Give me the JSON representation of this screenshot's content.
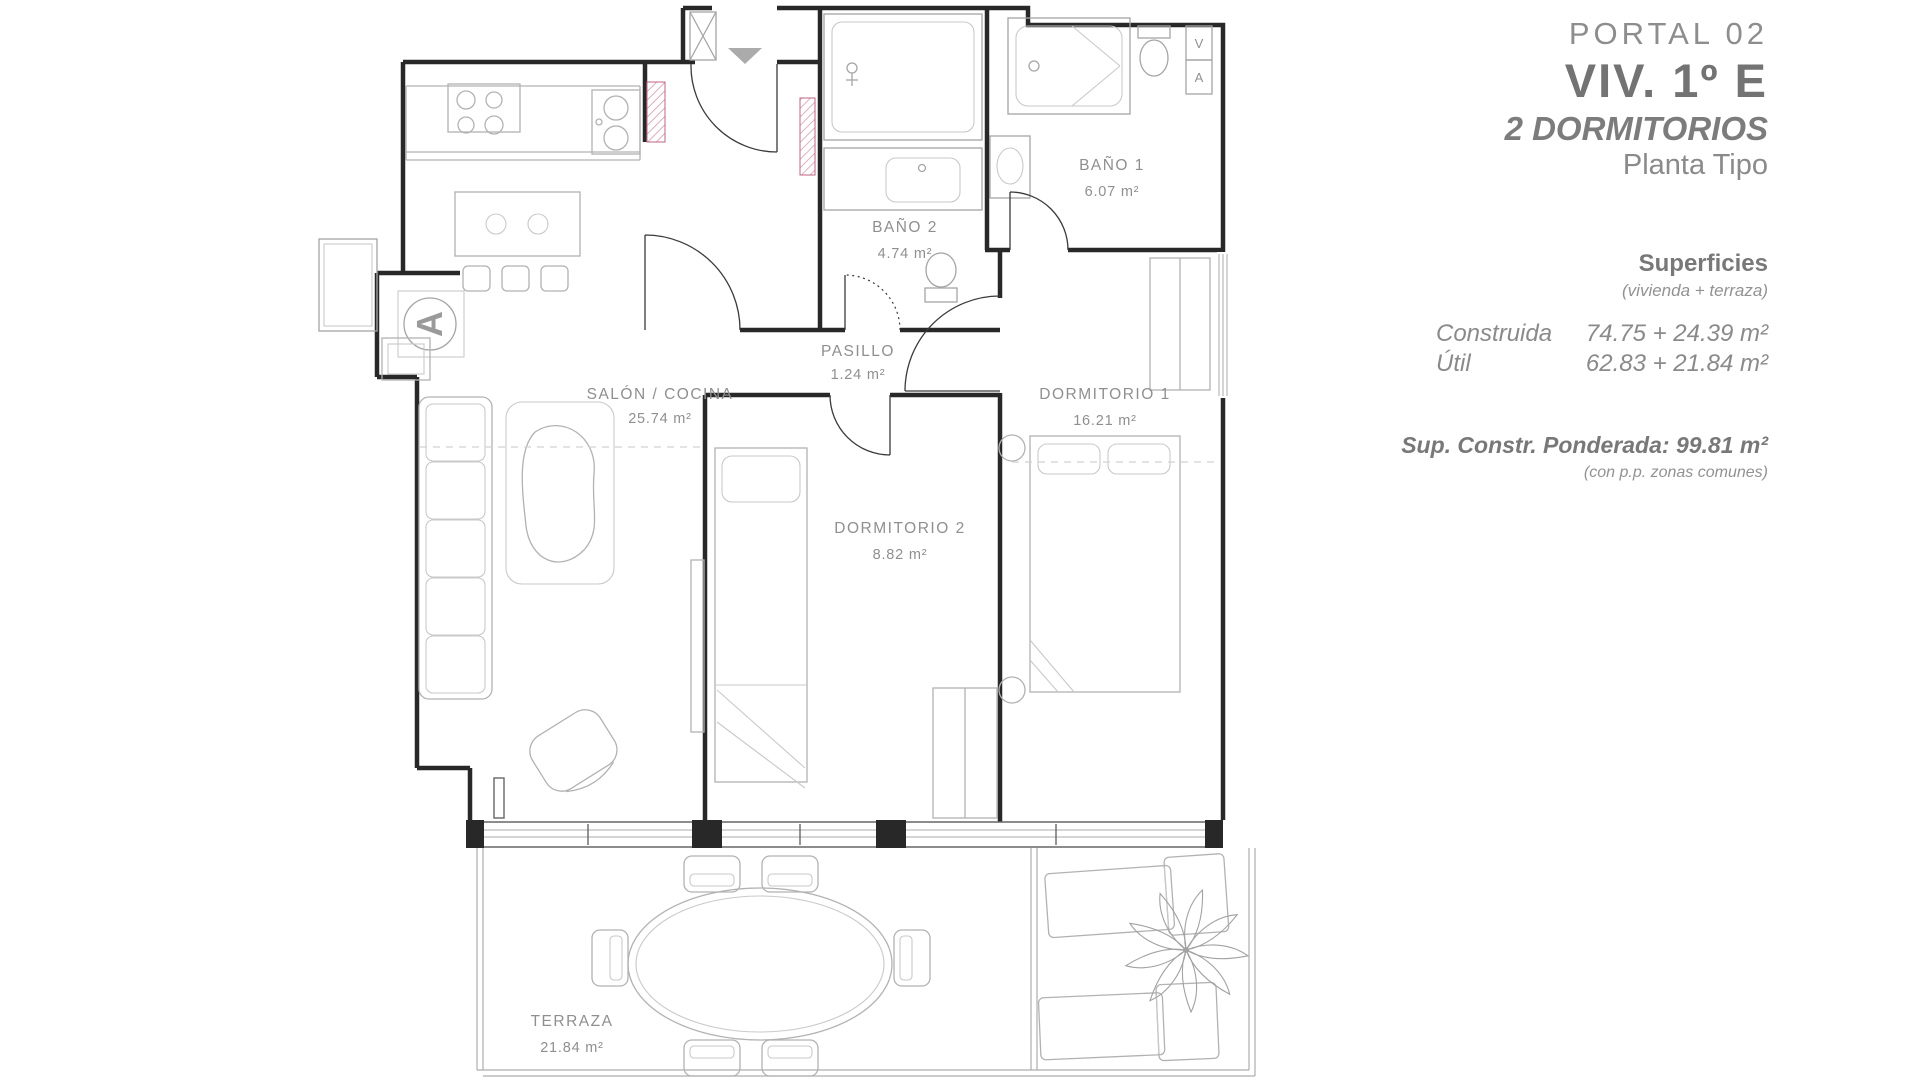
{
  "title_block": {
    "portal": "PORTAL 02",
    "unit": "VIV. 1º E",
    "bedrooms": "2 DORMITORIOS",
    "floor_type": "Planta Tipo",
    "surfaces": {
      "heading": "Superficies",
      "subheading": "(vivienda + terraza)",
      "rows": [
        {
          "label": "Construida",
          "value": "74.75 + 24.39 m²"
        },
        {
          "label": "Útil",
          "value": "62.83 + 21.84 m²"
        }
      ],
      "weighted": "Sup. Constr. Ponderada: 99.81 m²",
      "weighted_note": "(con p.p. zonas comunes)"
    }
  },
  "floor_plan": {
    "rooms": [
      {
        "id": "bano1",
        "name": "BAÑO 1",
        "area": "6.07 m²"
      },
      {
        "id": "bano2",
        "name": "BAÑO 2",
        "area": "4.74 m²"
      },
      {
        "id": "pasillo",
        "name": "PASILLO",
        "area": "1.24 m²"
      },
      {
        "id": "salon",
        "name": "SALÓN / COCINA",
        "area": "25.74 m²"
      },
      {
        "id": "dorm1",
        "name": "DORMITORIO 1",
        "area": "16.21 m²"
      },
      {
        "id": "dorm2",
        "name": "DORMITORIO 2",
        "area": "8.82 m²"
      },
      {
        "id": "terraza",
        "name": "TERRAZA",
        "area": "21.84 m²"
      }
    ],
    "markers": {
      "section_marker": "A",
      "vent_v": "V",
      "vent_a": "A"
    },
    "colors": {
      "wall": "#282828",
      "furniture": "#b2b2b2",
      "shaft_hatch": "#c4728f",
      "label": "#8f8f8f",
      "entrance_arrow": "#ababab"
    }
  }
}
